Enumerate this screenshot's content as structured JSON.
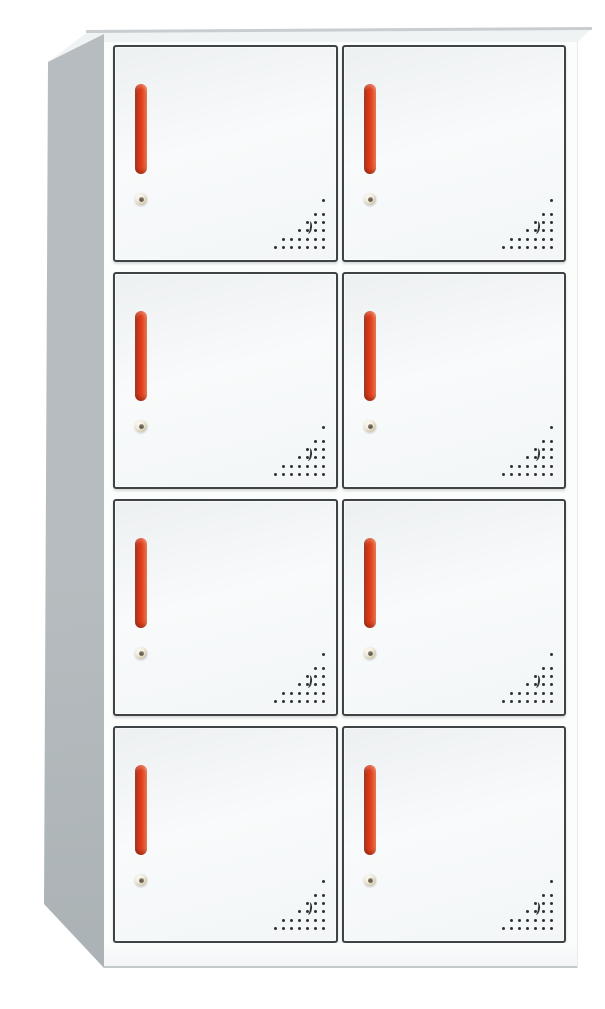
{
  "meta": {
    "description": "White eight-door steel locker cabinet with red vertical handles, round keyhole locks and triangular perforated vent patterns, shown in slight three-quarter view on a white background"
  },
  "colors": {
    "background": "#ffffff",
    "side_panel": "#b6bcbf",
    "side_panel_dark": "#a9b0b3",
    "top_face": "#f0f3f4",
    "top_edge": "#c9cdcf",
    "front_face": "#fbfcfc",
    "door_fill": "#f3f6f7",
    "door_fill_dark": "#edf0f1",
    "door_border": "#3e4346",
    "handle_red_dark": "#9c2a14",
    "handle_red": "#e0401e",
    "handle_red_light": "#f3764a",
    "lock_outer": "#f1ecdd",
    "lock_mid": "#cfc5a9",
    "lock_center": "#6a6150",
    "vent_dot": "#2f3335",
    "base_line": "#c3c8ca"
  },
  "cabinet": {
    "rows": 4,
    "columns": 2,
    "door_count": 8,
    "doors": [
      {
        "id": 1,
        "row": 1,
        "col": 1
      },
      {
        "id": 2,
        "row": 1,
        "col": 2
      },
      {
        "id": 3,
        "row": 2,
        "col": 1
      },
      {
        "id": 4,
        "row": 2,
        "col": 2
      },
      {
        "id": 5,
        "row": 3,
        "col": 1
      },
      {
        "id": 6,
        "row": 3,
        "col": 2
      },
      {
        "id": 7,
        "row": 4,
        "col": 1
      },
      {
        "id": 8,
        "row": 4,
        "col": 2
      }
    ],
    "door": {
      "handle": {
        "style": "vertical-bar",
        "color_ref": "handle_red"
      },
      "lock": {
        "style": "round-keyhole"
      },
      "vent": {
        "dot_size": 3,
        "col_spacing": 8,
        "rows": [
          {
            "y": 0,
            "count": 1
          },
          {
            "y": 14,
            "count": 2
          },
          {
            "y": 22,
            "count": 3
          },
          {
            "y": 30,
            "count": 4
          },
          {
            "y": 39,
            "count": 6
          },
          {
            "y": 47,
            "count": 7
          }
        ],
        "crescent": {
          "right": 13,
          "top": 22
        }
      }
    }
  }
}
